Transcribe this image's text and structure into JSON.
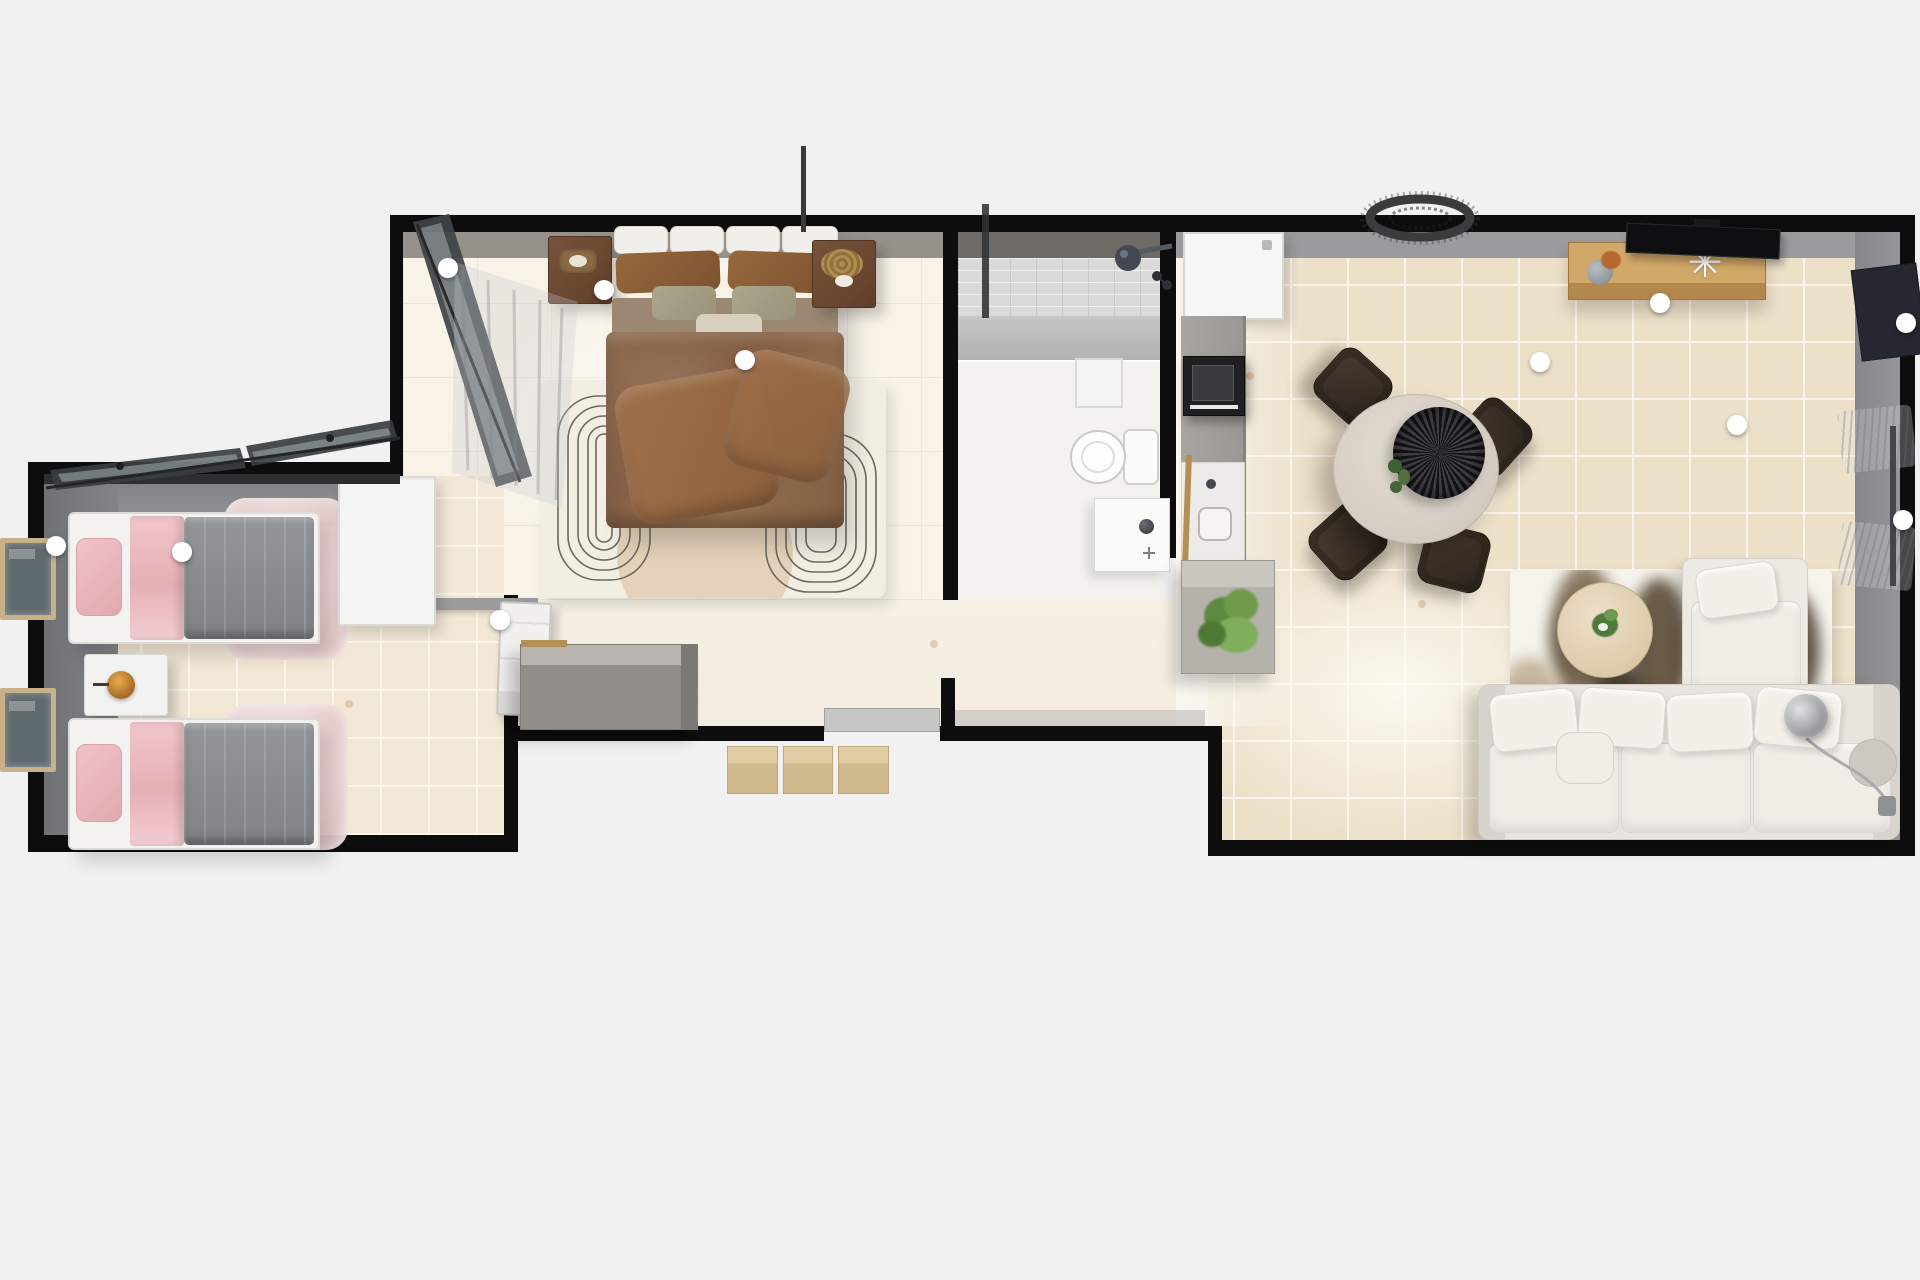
{
  "app": {
    "title": "3D floor plan — top-down render of a single-storey holiday lodge",
    "view": "top-down 3D"
  },
  "palette": {
    "background": "#f1f1f2",
    "walls": "#0d0d0e",
    "tile_beige": "#ece0c9",
    "tile_cream": "#f8f2e7",
    "wood_accent": "#c79d5f",
    "sofa_ivory": "#e9e5de",
    "bed_brown": "#8a6950",
    "bed_pink": "#eec3c8",
    "duvet_gray": "#8c8f93",
    "plant_green": "#5a7d3f",
    "chair_brown": "#30261e"
  },
  "rooms": [
    {
      "id": "twin-bedroom",
      "label": "Twin bedroom"
    },
    {
      "id": "master-bedroom",
      "label": "Master bedroom"
    },
    {
      "id": "bathroom",
      "label": "Shower room"
    },
    {
      "id": "hallway",
      "label": "Hallway / entrance"
    },
    {
      "id": "living-kitchen",
      "label": "Open-plan kitchen, dining and living room"
    }
  ],
  "furniture": {
    "twin_bed_1": {
      "label": "Single bed with pink throw and gray duvet"
    },
    "twin_bed_2": {
      "label": "Single bed with pink throw and gray duvet"
    },
    "twin_rug": {
      "label": "Pink bedside rug"
    },
    "twin_nightstand": {
      "label": "Bedside table with amber lamp"
    },
    "twin_wardrobe": {
      "label": "White wardrobe"
    },
    "twin_door": {
      "label": "Twin bedroom door (open)"
    },
    "left_window": {
      "label": "Window"
    },
    "twin_open_window": {
      "label": "Open casement window"
    },
    "master_bed": {
      "label": "Double bed with brown bedding"
    },
    "master_nightstand_left": {
      "label": "Nightstand with tray"
    },
    "master_nightstand_right": {
      "label": "Nightstand with woven basket"
    },
    "master_rug": {
      "label": "Cream rug with concentric line pattern"
    },
    "master_open_window": {
      "label": "Open window with sheer curtain"
    },
    "divider_wall": {
      "label": "Partition wall"
    },
    "hall_dresser": {
      "label": "Hallway sideboard"
    },
    "entry_door": {
      "label": "Entrance door"
    },
    "entry_steps": {
      "label": "Entrance steps"
    },
    "threshold": {
      "label": "Entrance threshold"
    },
    "shower": {
      "label": "Walk-in shower"
    },
    "shower_screen": {
      "label": "Glass shower screen"
    },
    "shower_head": {
      "label": "Shower head and mixer"
    },
    "bath_cabinet": {
      "label": "Bathroom cabinet"
    },
    "toilet": {
      "label": "Toilet"
    },
    "vanity": {
      "label": "Wash basin unit"
    },
    "vent_pipe": {
      "label": "Flue / vent pipe"
    },
    "fridge": {
      "label": "Fridge / tall kitchen unit"
    },
    "oven": {
      "label": "Built-in cooker"
    },
    "kitchen_counter": {
      "label": "Kitchen worktop"
    },
    "kitchen_sink": {
      "label": "Kitchen sink"
    },
    "kitchen_island": {
      "label": "Counter end unit"
    },
    "counter_plant": {
      "label": "Potted plant"
    },
    "dining_table": {
      "label": "Round dining table"
    },
    "dining_disc": {
      "label": "Dark centrepiece platter"
    },
    "dining_greens": {
      "label": "Table greenery"
    },
    "dining_chair": {
      "label": "Dining chair"
    },
    "ceiling_light": {
      "label": "Rattan ceiling light"
    },
    "media_console": {
      "label": "Wooden media console"
    },
    "tv": {
      "label": "Television"
    },
    "vase": {
      "label": "Vase with flowers"
    },
    "coral": {
      "label": "Coral ornament",
      "glyph": "✳"
    },
    "wall_panel": {
      "label": "Dark wall panel"
    },
    "curtains": {
      "label": "Sheer curtains"
    },
    "sofa": {
      "label": "L-shaped ivory sofa"
    },
    "chaise": {
      "label": "Chaise lounge"
    },
    "footstool": {
      "label": "Footstool"
    },
    "round_pillow": {
      "label": "Round cushion"
    },
    "coffee_table": {
      "label": "Round wooden coffee table"
    },
    "living_rug": {
      "label": "Abstract taupe rug"
    },
    "floor_lamp": {
      "label": "Globe floor lamp"
    }
  },
  "markers": {
    "label": "Light / camera marker",
    "light_count": 11,
    "positions": [
      [
        56,
        546
      ],
      [
        182,
        552
      ],
      [
        448,
        268
      ],
      [
        604,
        290
      ],
      [
        745,
        360
      ],
      [
        500,
        620
      ],
      [
        1540,
        362
      ],
      [
        1660,
        303
      ],
      [
        1737,
        425
      ],
      [
        1906,
        323
      ],
      [
        1903,
        520
      ]
    ]
  }
}
